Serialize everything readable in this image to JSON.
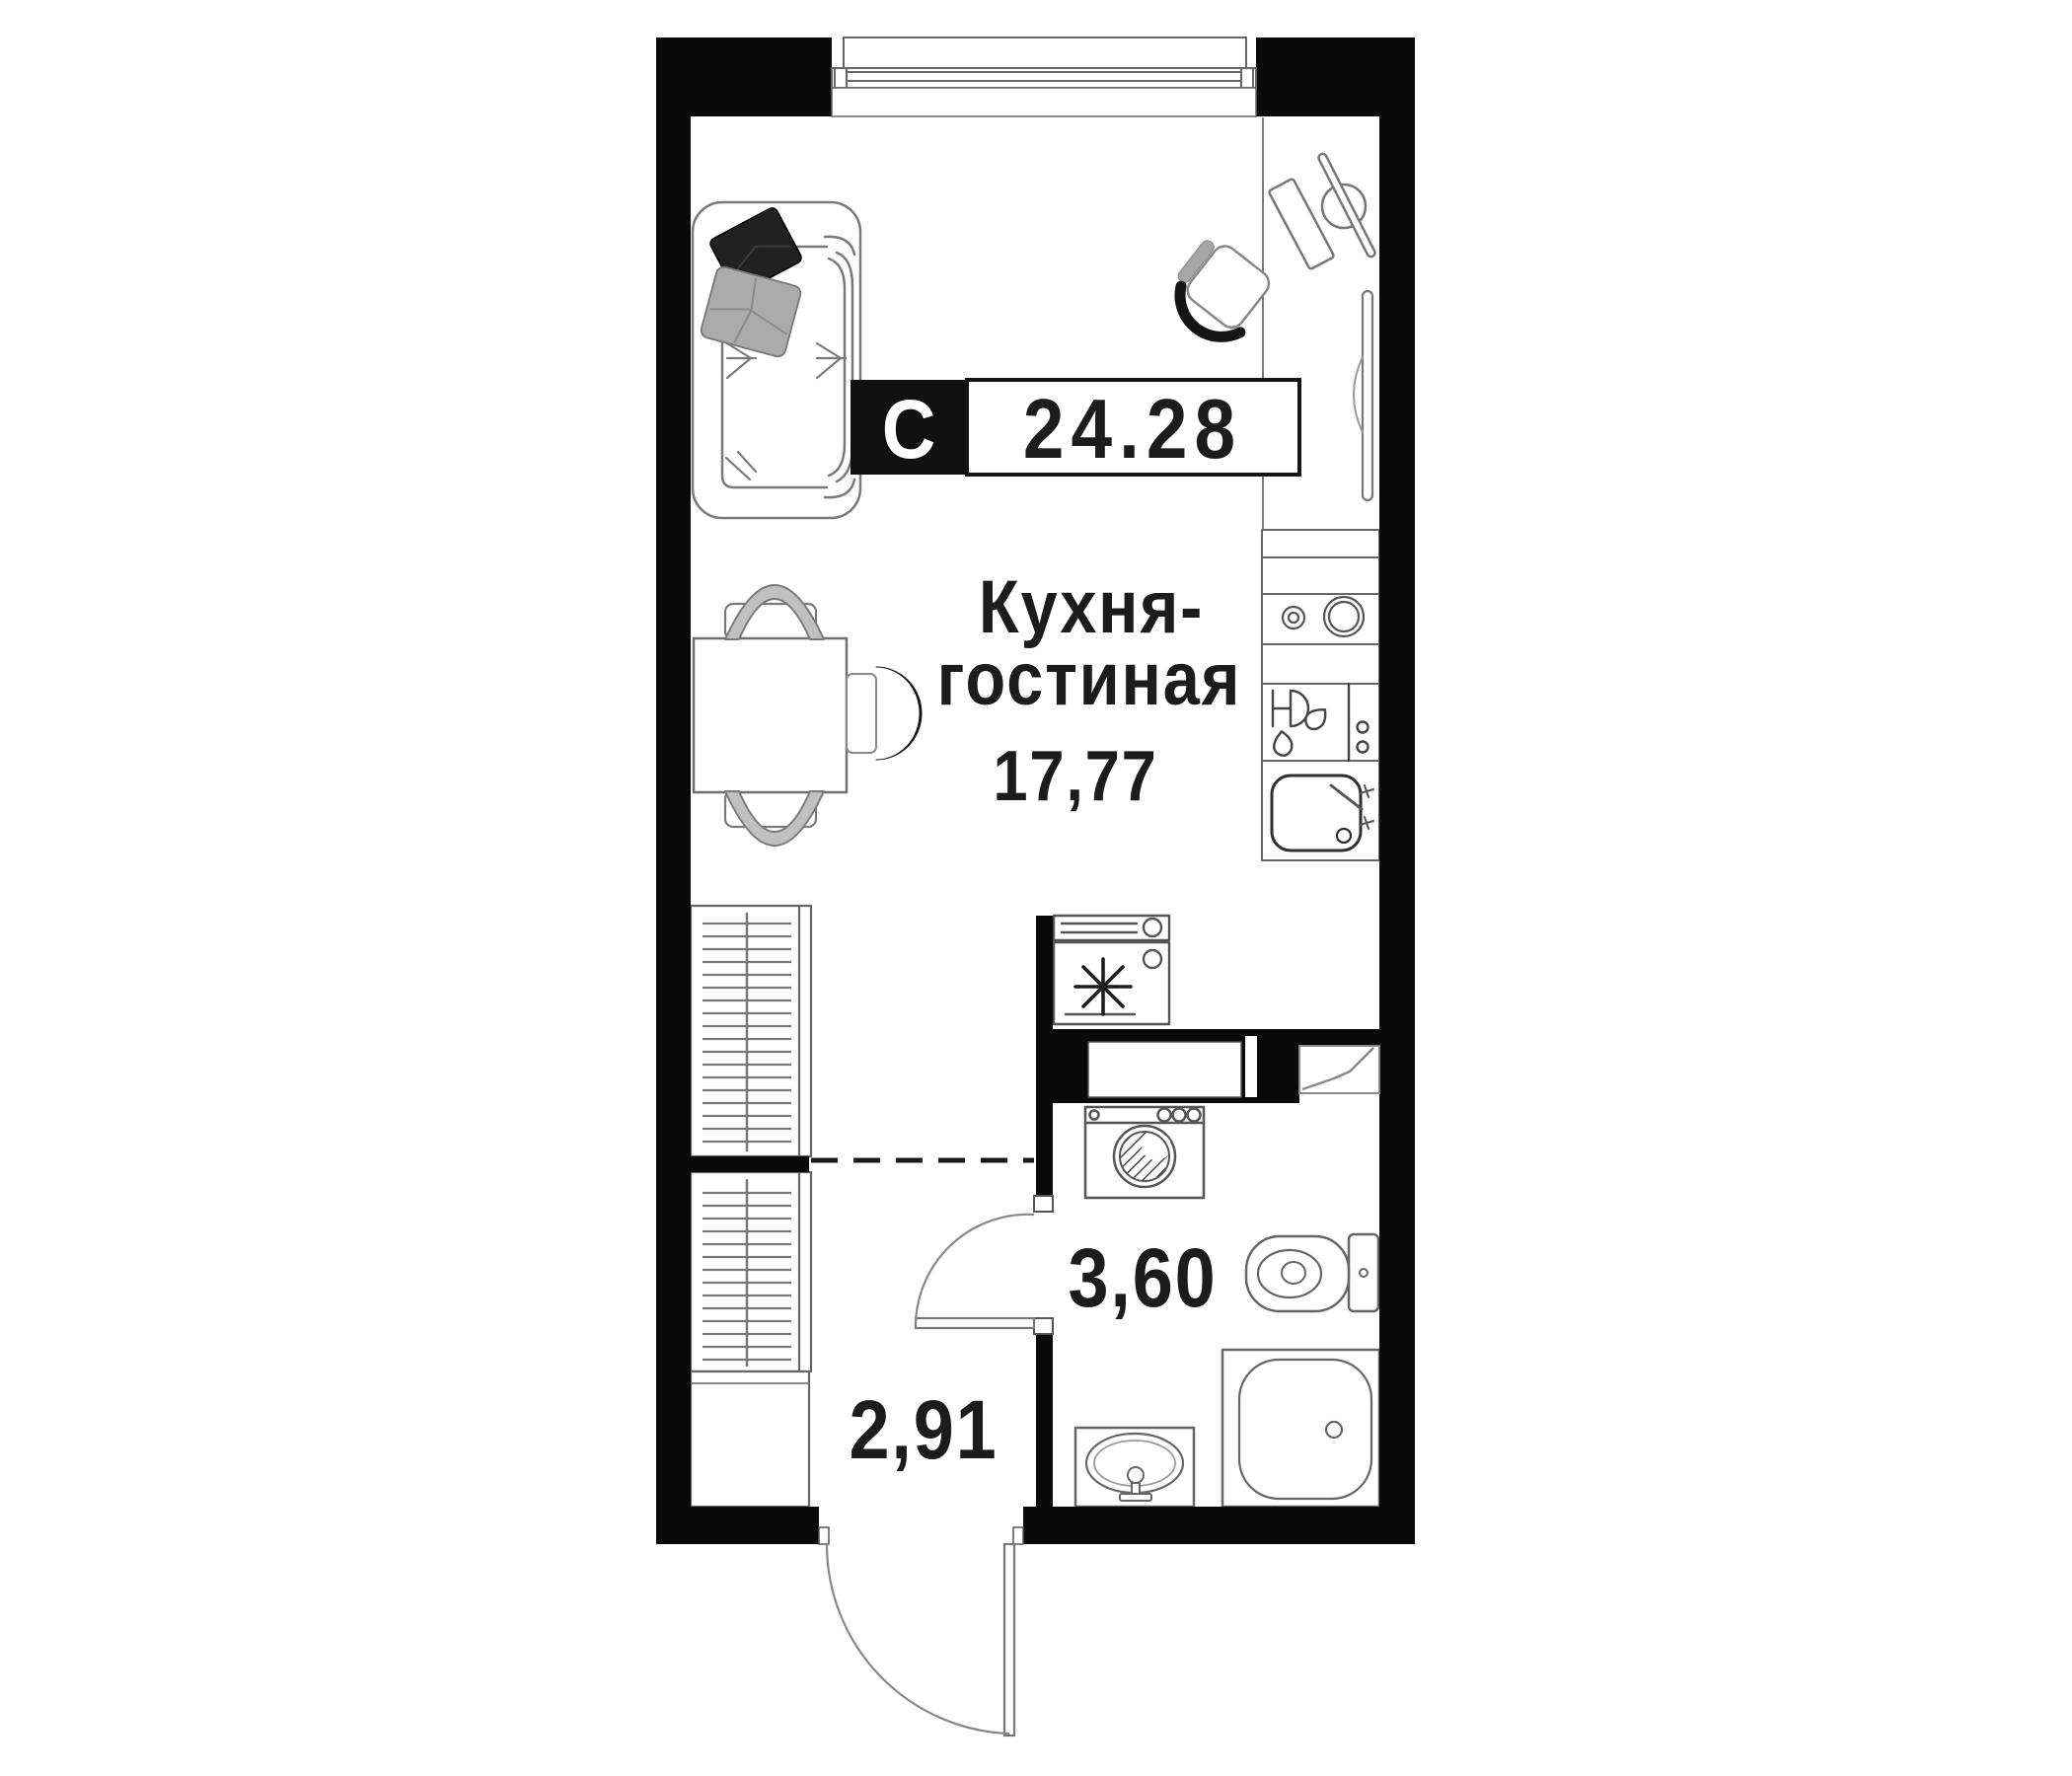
{
  "floor_plan": {
    "badge": {
      "type_label": "С",
      "total_area": "24.28"
    },
    "rooms": {
      "kitchen_living": {
        "label_line1": "Кухня-",
        "label_line2": "гостиная",
        "area": "17,77"
      },
      "bathroom": {
        "area": "3,60"
      },
      "hallway": {
        "area": "2,91"
      }
    },
    "colors": {
      "background": "#ffffff",
      "walls": "#0a0a0a",
      "badge_bg": "#101010",
      "badge_border": "#141414",
      "badge_text": "#ffffff",
      "label_text": "#1c1c1c",
      "furniture_line": "#777777",
      "pillow_dark": "#212121",
      "pillow_light": "#ababab",
      "chair_band": "#c0c0c0"
    },
    "fixtures": [
      "window",
      "sofa",
      "pillow-dark",
      "pillow-light",
      "dining-table",
      "dining-chair-top",
      "dining-chair-bottom",
      "accent-chair",
      "desk",
      "desk-chair",
      "desk-stool",
      "floor-lamp",
      "mirror-panel",
      "kitchen-counter",
      "hob-burners",
      "dishwasher",
      "wine-glass",
      "kitchen-sink",
      "refrigerator-snowflake",
      "appliance-box",
      "duct-niche",
      "washing-machine",
      "toilet",
      "bathtub",
      "washbasin",
      "wardrobe-upper",
      "wardrobe-lower",
      "storage-box",
      "bathroom-door",
      "entrance-door",
      "zone-dashed-line"
    ]
  }
}
